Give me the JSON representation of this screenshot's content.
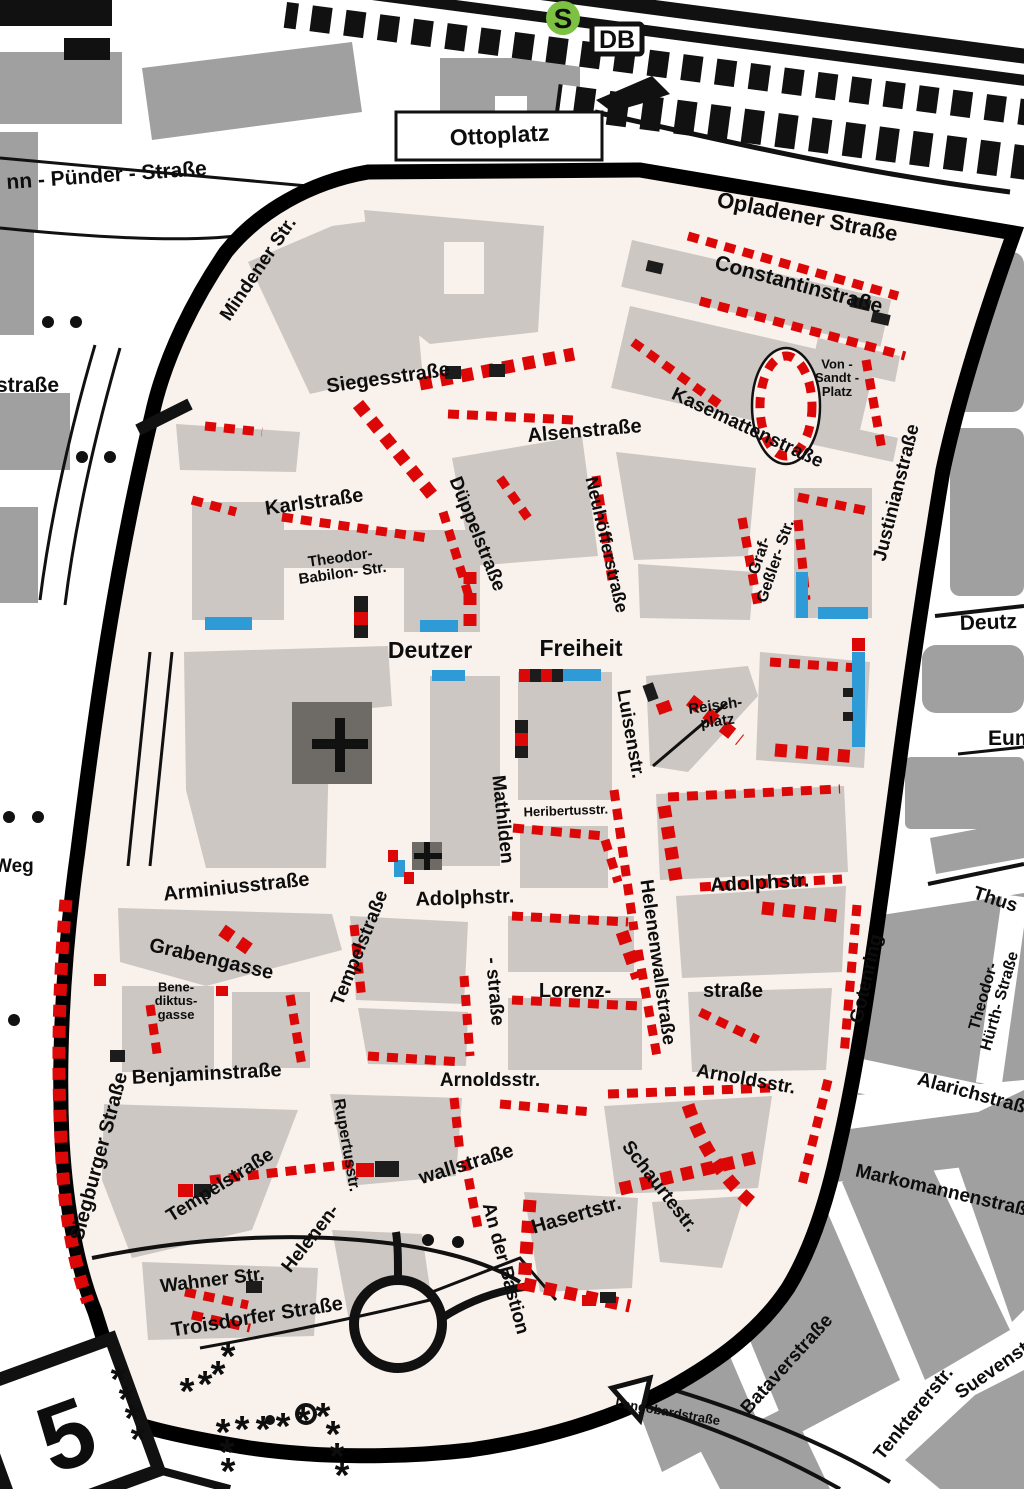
{
  "map": {
    "type": "city-district parking zone map",
    "zone_fill": "#f8f1ec",
    "boundary_color": "#000000",
    "parking_marker_color": "#dc0808",
    "bus_bay_color": "#2e9bd6",
    "building_color_inside": "#ccc7c2",
    "building_color_outside": "#a0a0a0"
  },
  "badges": {
    "s_bahn": {
      "label": "S",
      "bg": "#7cc142",
      "fg": "#ffffff"
    },
    "db": {
      "label": "DB",
      "bg": "#ffffff",
      "fg": "#111111"
    },
    "road_number": {
      "label": "5",
      "bg": "#ffffff",
      "fg": "#111111"
    }
  },
  "symbols": {
    "no_parking_marker": "*",
    "church_cross": "+"
  },
  "street_labels": [
    {
      "n": "ottoplatz",
      "t": "Ottoplatz",
      "x": 500,
      "y": 143,
      "r": -3,
      "s": 23
    },
    {
      "n": "pünder-straße",
      "t": "nn - Pünder - Straße",
      "x": 107,
      "y": 182,
      "r": -4,
      "s": 21
    },
    {
      "n": "mindener-str",
      "t": "Mindener Str.",
      "x": 263,
      "y": 272,
      "r": -56,
      "s": 19
    },
    {
      "n": "opladener-straße",
      "t": "Opladener Straße",
      "x": 806,
      "y": 224,
      "r": 11,
      "s": 22
    },
    {
      "n": "constantinstraße",
      "t": "Constantinstraße",
      "x": 797,
      "y": 291,
      "r": 15,
      "s": 21
    },
    {
      "n": "straße-left",
      "t": "straße",
      "x": -4,
      "y": 392,
      "r": 0,
      "s": 21,
      "a": "start"
    },
    {
      "n": "siegesstraße",
      "t": "Siegesstraße",
      "x": 389,
      "y": 384,
      "r": -8,
      "s": 20
    },
    {
      "n": "alsenstraße",
      "t": "Alsenstraße",
      "x": 585,
      "y": 437,
      "r": -5,
      "s": 20
    },
    {
      "n": "kasemattenstraße",
      "t": "Kasemattenstraße",
      "x": 745,
      "y": 433,
      "r": 25,
      "s": 19
    },
    {
      "n": "von-sandt-platz",
      "t": "Von -\nSandt -\nPlatz",
      "x": 837,
      "y": 382,
      "r": 0,
      "s": 13
    },
    {
      "n": "justinianstraße",
      "t": "Justinianstraße",
      "x": 902,
      "y": 494,
      "r": -76,
      "s": 19
    },
    {
      "n": "düppelstraße",
      "t": "Düppelstraße",
      "x": 472,
      "y": 536,
      "r": 68,
      "s": 19
    },
    {
      "n": "neuhöfferstraße",
      "t": "Neuhöfferstraße",
      "x": 601,
      "y": 546,
      "r": 77,
      "s": 18
    },
    {
      "n": "karlstraße",
      "t": "Karlstraße",
      "x": 315,
      "y": 508,
      "r": -8,
      "s": 20
    },
    {
      "n": "theodor-babilon-str",
      "t": "Theodor-\nBabilon- Str.",
      "x": 342,
      "y": 570,
      "r": -8,
      "s": 15
    },
    {
      "n": "graf-geßler-str",
      "t": "Graf-\nGeßler- Str.",
      "x": 772,
      "y": 560,
      "r": -71,
      "s": 16
    },
    {
      "n": "deutz-right",
      "t": "Deutz",
      "x": 960,
      "y": 630,
      "r": -2,
      "s": 21,
      "a": "start"
    },
    {
      "n": "deutzer",
      "t": "Deutzer",
      "x": 430,
      "y": 658,
      "r": 0,
      "s": 23
    },
    {
      "n": "freiheit",
      "t": "Freiheit",
      "x": 581,
      "y": 656,
      "r": 0,
      "s": 23
    },
    {
      "n": "luisenstr",
      "t": "Luisenstr.",
      "x": 625,
      "y": 735,
      "r": 80,
      "s": 19
    },
    {
      "n": "reischplatz",
      "t": "Reisch-\nplatz",
      "x": 717,
      "y": 718,
      "r": -8,
      "s": 15
    },
    {
      "n": "eum-right",
      "t": "Eum",
      "x": 988,
      "y": 745,
      "r": 0,
      "s": 21,
      "a": "start"
    },
    {
      "n": "mathilden",
      "t": "Mathilden",
      "x": 497,
      "y": 820,
      "r": 84,
      "s": 19
    },
    {
      "n": "mathilden-straße2",
      "t": "- straße",
      "x": 489,
      "y": 992,
      "r": 85,
      "s": 19
    },
    {
      "n": "heribertusstr",
      "t": "Heribertusstr.",
      "x": 566,
      "y": 815,
      "r": -2,
      "s": 13
    },
    {
      "n": "adolphstr-left",
      "t": "Adolphstr.",
      "x": 465,
      "y": 904,
      "r": -2,
      "s": 20
    },
    {
      "n": "adolphstr-right",
      "t": "Adolphstr.",
      "x": 760,
      "y": 889,
      "r": -3,
      "s": 20
    },
    {
      "n": "helenenwallstraße",
      "t": "Helenenwallstraße",
      "x": 652,
      "y": 963,
      "r": 82,
      "s": 19
    },
    {
      "n": "weg-left",
      "t": "Weg",
      "x": -6,
      "y": 872,
      "r": 0,
      "s": 19,
      "a": "start"
    },
    {
      "n": "arminiusstraße",
      "t": "Arminiusstraße",
      "x": 237,
      "y": 893,
      "r": -6,
      "s": 20
    },
    {
      "n": "tempelstraße-upper",
      "t": "Tempelstraße",
      "x": 365,
      "y": 950,
      "r": -68,
      "s": 19
    },
    {
      "n": "grabengasse",
      "t": "Grabengasse",
      "x": 210,
      "y": 965,
      "r": 13,
      "s": 20
    },
    {
      "n": "benediktusgasse",
      "t": "Bene-\ndiktus-\ngasse",
      "x": 176,
      "y": 1005,
      "r": 0,
      "s": 13
    },
    {
      "n": "thusneldastraße",
      "t": "Thus",
      "x": 972,
      "y": 898,
      "r": 18,
      "s": 19,
      "a": "start"
    },
    {
      "n": "gotenring",
      "t": "Gotenring",
      "x": 872,
      "y": 980,
      "r": -77,
      "s": 19
    },
    {
      "n": "theodor-hürth-straße",
      "t": "Theodor-\nHürth- Straße",
      "x": 996,
      "y": 1000,
      "r": -74,
      "s": 16
    },
    {
      "n": "lorenz",
      "t": "Lorenz-",
      "x": 575,
      "y": 997,
      "r": 0,
      "s": 20
    },
    {
      "n": "lorenz-straße2",
      "t": "straße",
      "x": 733,
      "y": 997,
      "r": 0,
      "s": 20
    },
    {
      "n": "benjaminstraße",
      "t": "Benjaminstraße",
      "x": 207,
      "y": 1080,
      "r": -3,
      "s": 20
    },
    {
      "n": "arnoldsstr-left",
      "t": "Arnoldsstr.",
      "x": 490,
      "y": 1086,
      "r": 0,
      "s": 19
    },
    {
      "n": "arnoldsstr-right",
      "t": "Arnoldsstr.",
      "x": 745,
      "y": 1085,
      "r": 10,
      "s": 19
    },
    {
      "n": "alarichstraße",
      "t": "Alarichstraße",
      "x": 975,
      "y": 1100,
      "r": 15,
      "s": 19
    },
    {
      "n": "siegburger-straße",
      "t": "Siegburger Straße",
      "x": 105,
      "y": 1158,
      "r": -75,
      "s": 20
    },
    {
      "n": "tempelstraße-lower",
      "t": "Tempelstraße",
      "x": 223,
      "y": 1190,
      "r": -32,
      "s": 19
    },
    {
      "n": "rupertusstr",
      "t": "Rupertusstr.",
      "x": 342,
      "y": 1146,
      "r": 80,
      "s": 16
    },
    {
      "n": "wallstraße",
      "t": "wallstraße",
      "x": 468,
      "y": 1170,
      "r": -17,
      "s": 20
    },
    {
      "n": "an-der-bastion",
      "t": "An der Bastion",
      "x": 500,
      "y": 1270,
      "r": 75,
      "s": 19
    },
    {
      "n": "schaurtestr",
      "t": "Schaurtestr.",
      "x": 655,
      "y": 1190,
      "r": 52,
      "s": 19
    },
    {
      "n": "hasertstr",
      "t": "Hasertstr.",
      "x": 578,
      "y": 1221,
      "r": -16,
      "s": 20
    },
    {
      "n": "helenen-lower",
      "t": "Helenen-",
      "x": 315,
      "y": 1242,
      "r": -52,
      "s": 19
    },
    {
      "n": "markomannenstraße",
      "t": "Markomannenstraße",
      "x": 945,
      "y": 1197,
      "r": 13,
      "s": 19
    },
    {
      "n": "wahner-str",
      "t": "Wahner Str.",
      "x": 213,
      "y": 1286,
      "r": -7,
      "s": 19
    },
    {
      "n": "troisdorfer-straße",
      "t": "Troisdorfer Straße",
      "x": 258,
      "y": 1323,
      "r": -9,
      "s": 20
    },
    {
      "n": "langobardstraße",
      "t": "Langobardstraße",
      "x": 667,
      "y": 1416,
      "r": 10,
      "s": 13
    },
    {
      "n": "bataverstraße",
      "t": "Bataverstraße",
      "x": 791,
      "y": 1368,
      "r": -48,
      "s": 19
    },
    {
      "n": "tenktererstr",
      "t": "Tenktererstr.",
      "x": 918,
      "y": 1417,
      "r": -51,
      "s": 19
    },
    {
      "n": "suevenstr",
      "t": "Suevenstr.",
      "x": 1000,
      "y": 1372,
      "r": -35,
      "s": 19
    }
  ]
}
